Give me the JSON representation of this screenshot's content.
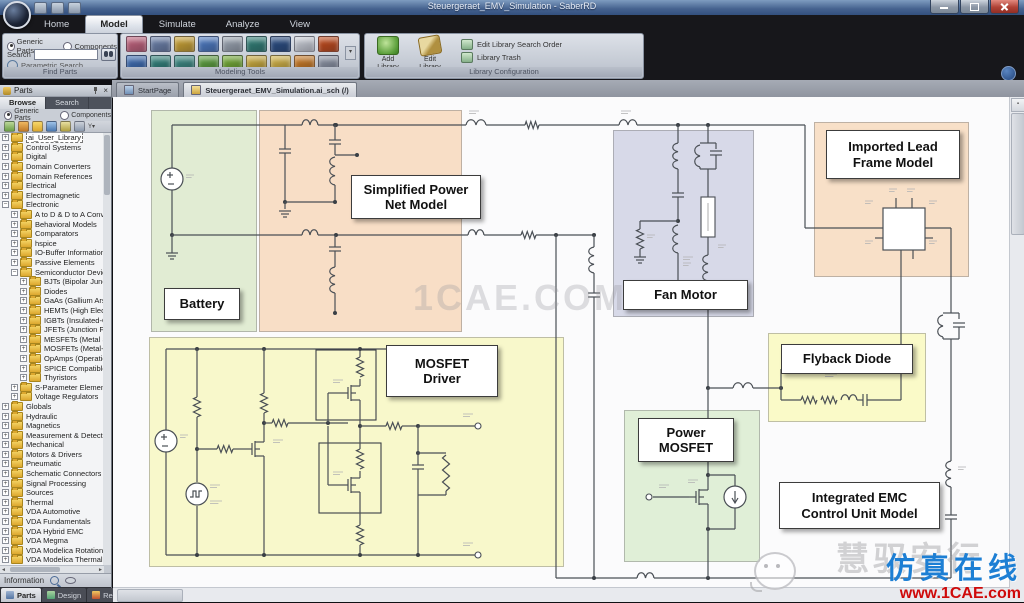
{
  "window": {
    "title": "Steuergeraet_EMV_Simulation - SaberRD"
  },
  "ribbon": {
    "tabs": [
      {
        "label": "Home",
        "active": false
      },
      {
        "label": "Model",
        "active": true
      },
      {
        "label": "Simulate",
        "active": false
      },
      {
        "label": "Analyze",
        "active": false
      },
      {
        "label": "View",
        "active": false
      }
    ],
    "find_parts": {
      "caption": "Find Parts",
      "generic_radio": "Generic Parts",
      "components_radio": "Components",
      "search_label": "Search",
      "search_value": "",
      "parametric_label": "Parametric Search"
    },
    "modeling_tools": {
      "caption": "Modeling Tools",
      "icon_colors": [
        "#c0607a",
        "#6a7fa8",
        "#c8a030",
        "#4a78c0",
        "#9aa4b0",
        "#2e7d74",
        "#274a80",
        "#c8ccd4",
        "#c04818",
        "#3a6ab0",
        "#2e8078",
        "#37867e",
        "#5a9e3a",
        "#70a830",
        "#c8a838",
        "#d0b040",
        "#c87820",
        "#8890a0"
      ]
    },
    "library_configuration": {
      "caption": "Library Configuration",
      "add_library": "Add Library",
      "edit_library": "Edit Library",
      "edit_search_order": "Edit Library Search Order",
      "library_trash": "Library Trash"
    }
  },
  "document_tabs": [
    {
      "label": "StartPage",
      "active": false
    },
    {
      "label": "Steuergeraet_EMV_Simulation.ai_sch (/)",
      "active": true
    }
  ],
  "sidebar": {
    "title": "Parts",
    "tabs": [
      {
        "label": "Browse",
        "active": true
      },
      {
        "label": "Search",
        "active": false
      }
    ],
    "generic_radio": "Generic Parts",
    "components_radio": "Components",
    "tree": [
      {
        "label": "ai_User_Library",
        "level": 0,
        "exp": "+",
        "sel": true
      },
      {
        "label": "Control Systems",
        "level": 0,
        "exp": "+"
      },
      {
        "label": "Digital",
        "level": 0,
        "exp": "+"
      },
      {
        "label": "Domain Converters",
        "level": 0,
        "exp": "+"
      },
      {
        "label": "Domain References",
        "level": 0,
        "exp": "+"
      },
      {
        "label": "Electrical",
        "level": 0,
        "exp": "+"
      },
      {
        "label": "Electromagnetic",
        "level": 0,
        "exp": "+"
      },
      {
        "label": "Electronic",
        "level": 0,
        "exp": "-"
      },
      {
        "label": "A to D & D to A Converte",
        "level": 1,
        "exp": "+"
      },
      {
        "label": "Behavioral Models",
        "level": 1,
        "exp": "+"
      },
      {
        "label": "Comparators",
        "level": 1,
        "exp": "+"
      },
      {
        "label": "hspice",
        "level": 1,
        "exp": "+"
      },
      {
        "label": "IO-Buffer Information Spe",
        "level": 1,
        "exp": "+"
      },
      {
        "label": "Passive Elements",
        "level": 1,
        "exp": "+"
      },
      {
        "label": "Semiconductor Devices",
        "level": 1,
        "exp": "-"
      },
      {
        "label": "BJTs (Bipolar Junction",
        "level": 2,
        "exp": "+"
      },
      {
        "label": "Diodes",
        "level": 2,
        "exp": "+"
      },
      {
        "label": "GaAs (Gallium Arseni",
        "level": 2,
        "exp": "+"
      },
      {
        "label": "HEMTs (High Electron",
        "level": 2,
        "exp": "+"
      },
      {
        "label": "IGBTs (Insulated-Gate",
        "level": 2,
        "exp": "+"
      },
      {
        "label": "JFETs (Junction Field-",
        "level": 2,
        "exp": "+"
      },
      {
        "label": "MESFETs (Metal Semi",
        "level": 2,
        "exp": "+"
      },
      {
        "label": "MOSFETs (Metal-Oxid",
        "level": 2,
        "exp": "+"
      },
      {
        "label": "OpAmps (Operational",
        "level": 2,
        "exp": "+"
      },
      {
        "label": "SPICE Compatible Mo",
        "level": 2,
        "exp": "+"
      },
      {
        "label": "Thyristors",
        "level": 2,
        "exp": "+"
      },
      {
        "label": "S-Parameter Elements",
        "level": 1,
        "exp": "+"
      },
      {
        "label": "Voltage Regulators",
        "level": 1,
        "exp": "+"
      },
      {
        "label": "Globals",
        "level": 0,
        "exp": "+"
      },
      {
        "label": "Hydraulic",
        "level": 0,
        "exp": "+"
      },
      {
        "label": "Magnetics",
        "level": 0,
        "exp": "+"
      },
      {
        "label": "Measurement & Detection",
        "level": 0,
        "exp": "+"
      },
      {
        "label": "Mechanical",
        "level": 0,
        "exp": "+"
      },
      {
        "label": "Motors & Drivers",
        "level": 0,
        "exp": "+"
      },
      {
        "label": "Pneumatic",
        "level": 0,
        "exp": "+"
      },
      {
        "label": "Schematic Connectors",
        "level": 0,
        "exp": "+"
      },
      {
        "label": "Signal Processing",
        "level": 0,
        "exp": "+"
      },
      {
        "label": "Sources",
        "level": 0,
        "exp": "+"
      },
      {
        "label": "Thermal",
        "level": 0,
        "exp": "+"
      },
      {
        "label": "VDA Automotive",
        "level": 0,
        "exp": "+"
      },
      {
        "label": "VDA Fundamentals",
        "level": 0,
        "exp": "+"
      },
      {
        "label": "VDA Hybrid EMC",
        "level": 0,
        "exp": "+"
      },
      {
        "label": "VDA Megma",
        "level": 0,
        "exp": "+"
      },
      {
        "label": "VDA Modelica Rotational",
        "level": 0,
        "exp": "+"
      },
      {
        "label": "VDA Modelica Thermal",
        "level": 0,
        "exp": "+"
      }
    ],
    "information_label": "Information",
    "bottom_tabs": [
      {
        "label": "Parts",
        "active": true,
        "icon": "parts"
      },
      {
        "label": "Design",
        "active": false,
        "icon": "design"
      },
      {
        "label": "Results",
        "active": false,
        "icon": "results"
      }
    ]
  },
  "canvas": {
    "center_watermark": "1CAE.COM",
    "regions": [
      {
        "id": "battery-region",
        "color": "#e1ecd3"
      },
      {
        "id": "power-net-region",
        "color": "#f8dec6"
      },
      {
        "id": "mosfet-driver-region",
        "color": "#f8f8cb"
      },
      {
        "id": "fan-motor-region",
        "color": "#d7d9e8"
      },
      {
        "id": "lead-frame-region",
        "color": "#f8e0c8"
      },
      {
        "id": "flyback-region",
        "color": "#fafac8"
      },
      {
        "id": "power-mosfet-region",
        "color": "#e0efd7"
      }
    ],
    "labels": [
      {
        "id": "battery",
        "lines": [
          "Battery"
        ]
      },
      {
        "id": "power-net",
        "lines": [
          "Simplified Power",
          "Net Model"
        ]
      },
      {
        "id": "mosfet-driver",
        "lines": [
          "MOSFET",
          "Driver"
        ]
      },
      {
        "id": "fan-motor",
        "lines": [
          "Fan Motor"
        ]
      },
      {
        "id": "lead-frame",
        "lines": [
          "Imported Lead",
          "Frame Model"
        ]
      },
      {
        "id": "flyback",
        "lines": [
          "Flyback Diode"
        ]
      },
      {
        "id": "power-mosfet",
        "lines": [
          "Power",
          "MOSFET"
        ]
      },
      {
        "id": "emc-unit",
        "lines": [
          "Integrated EMC",
          "Control Unit Model"
        ]
      }
    ]
  },
  "watermark_brand": {
    "gray_text": "慧驭安行",
    "blue_text": "仿真在线",
    "url": "www.1CAE.com"
  }
}
